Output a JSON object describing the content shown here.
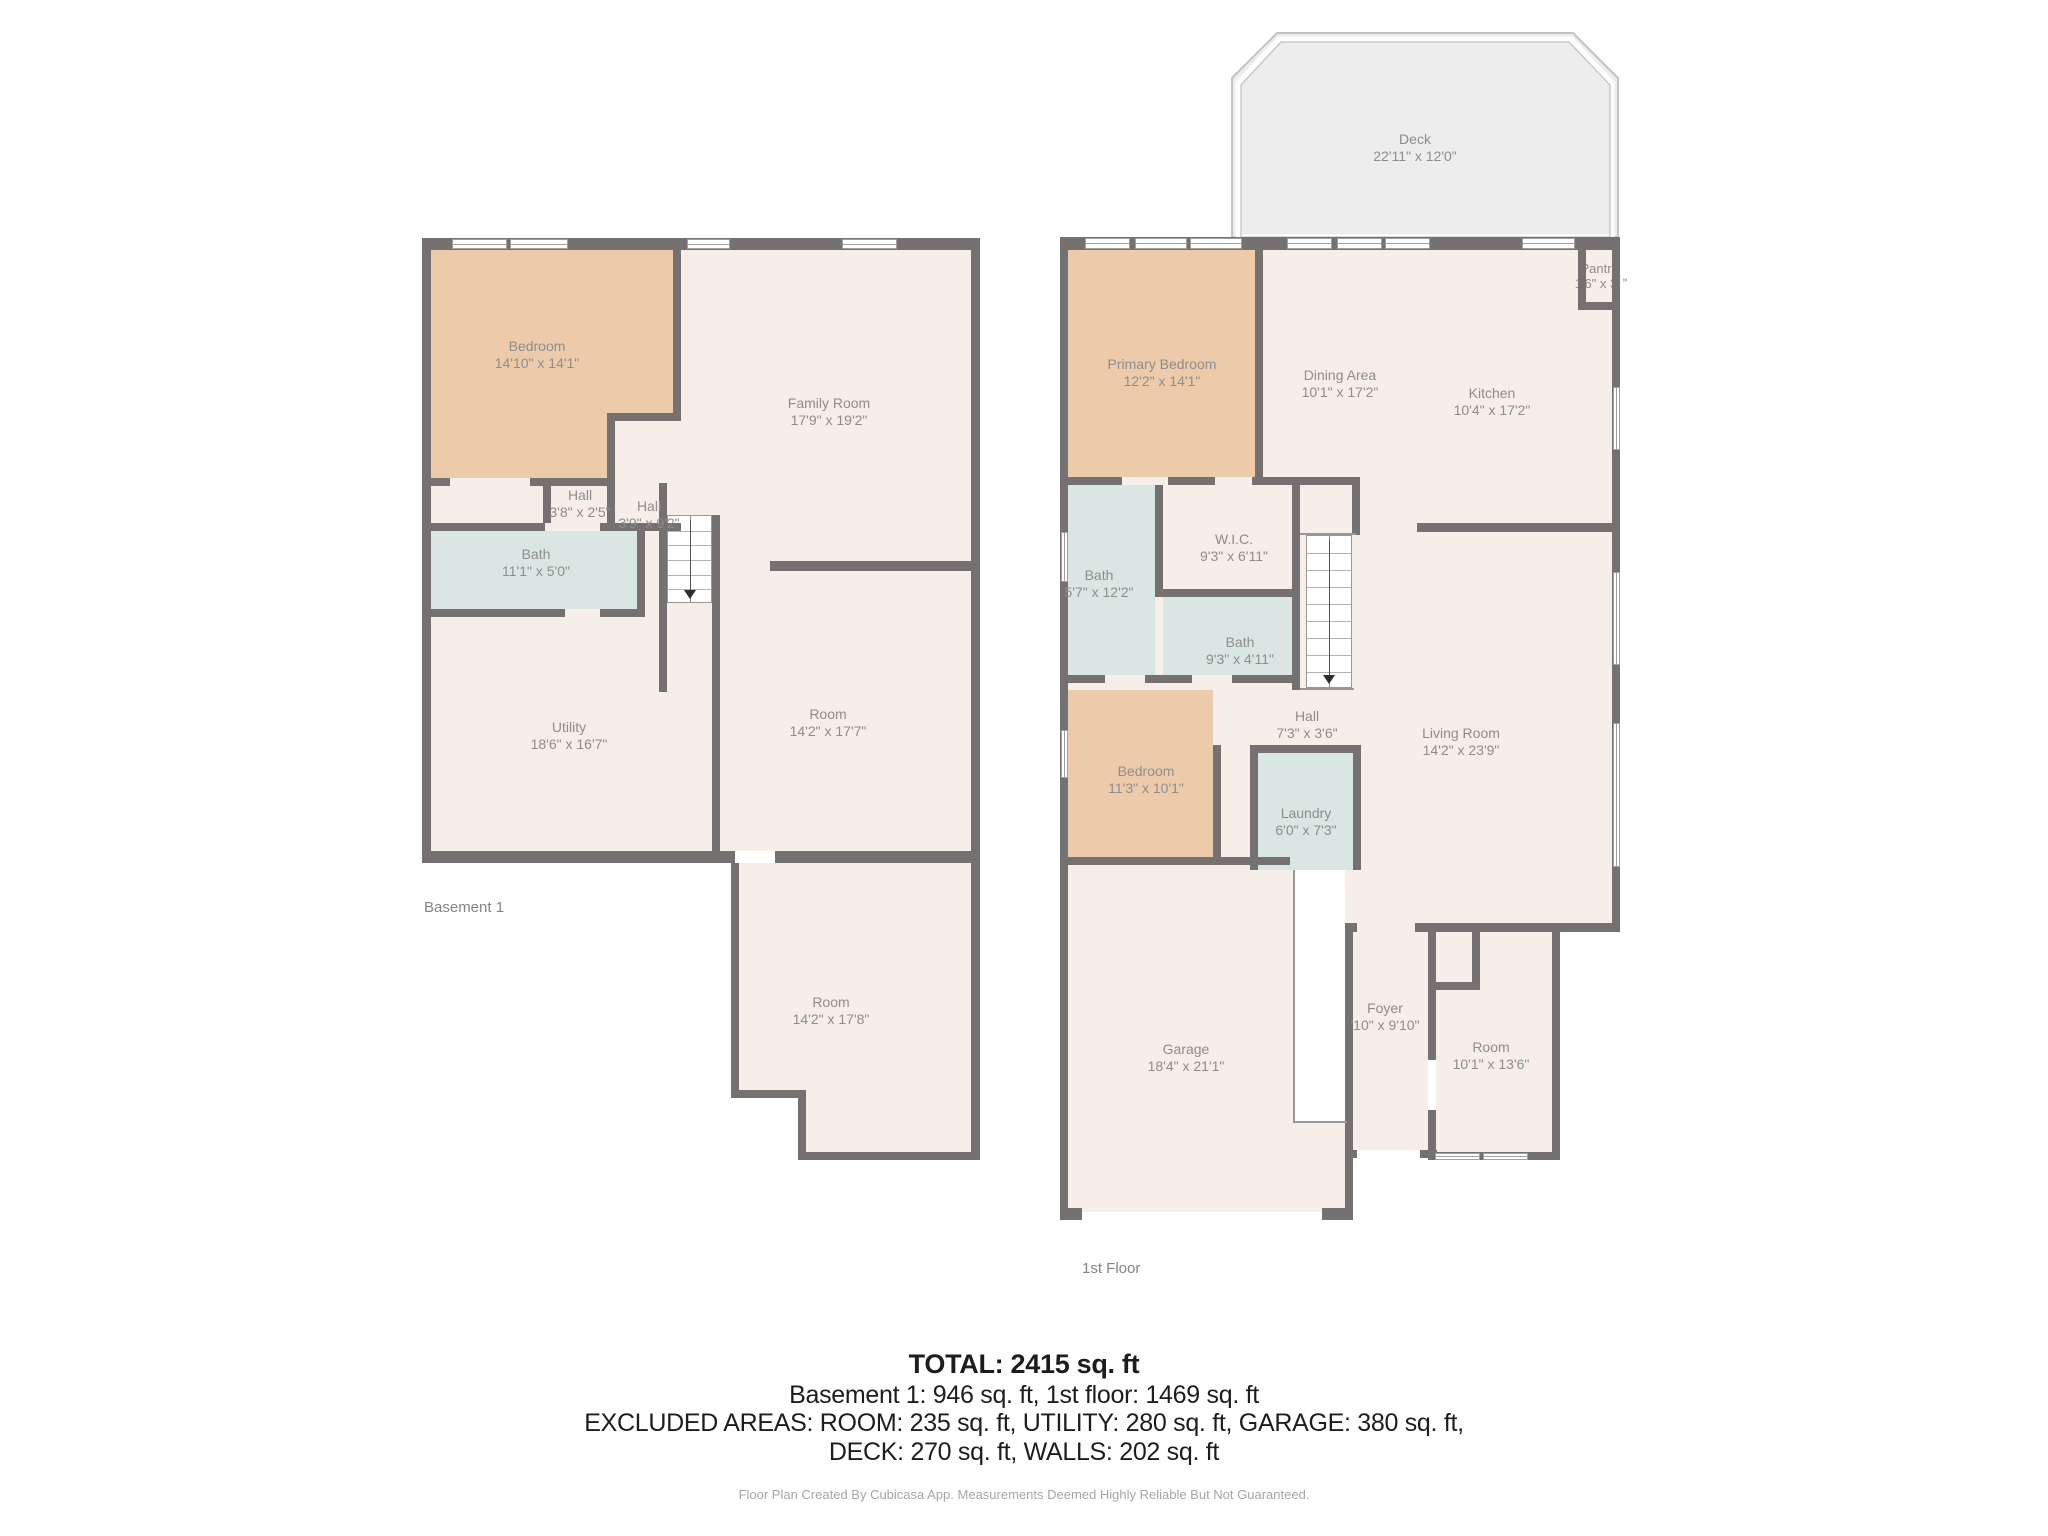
{
  "colors": {
    "wall": "#757170",
    "floor": "#f6eee8",
    "bedroom_fill": "#edcbaa",
    "bath_fill": "#d9e6e3",
    "deck_fill": "#ededed",
    "deck_line": "#c5c2bf",
    "label_text": "#8d8d8d",
    "summary_text": "#1d1d1d",
    "footer_text": "#a6a6a6"
  },
  "basement": {
    "caption": "Basement 1",
    "rooms": [
      {
        "name": "Bedroom",
        "dims": "14'10\" x 14'1\""
      },
      {
        "name": "Family Room",
        "dims": "17'9\" x 19'2\""
      },
      {
        "name": "Hall",
        "dims": "3'8\" x 2'5\""
      },
      {
        "name": "Hall",
        "dims": "3'9\" x 9'2\""
      },
      {
        "name": "Bath",
        "dims": "11'1\" x 5'0\""
      },
      {
        "name": "Utility",
        "dims": "18'6\" x 16'7\""
      },
      {
        "name": "Room",
        "dims": "14'2\" x 17'7\""
      },
      {
        "name": "Room",
        "dims": "14'2\" x 17'8\""
      }
    ]
  },
  "first_floor": {
    "caption": "1st Floor",
    "rooms": [
      {
        "name": "Deck",
        "dims": "22'11\" x 12'0\""
      },
      {
        "name": "Primary Bedroom",
        "dims": "12'2\" x 14'1\""
      },
      {
        "name": "Dining Area",
        "dims": "10'1\" x 17'2\""
      },
      {
        "name": "Kitchen",
        "dims": "10'4\" x 17'2\""
      },
      {
        "name": "Pantr",
        "dims": "1'6\" x 3",
        "overflow_mark": "\""
      },
      {
        "name": "Bath",
        "dims": "5'7\" x 12'2\""
      },
      {
        "name": "W.I.C.",
        "dims": "9'3\" x 6'11\""
      },
      {
        "name": "Bath",
        "dims": "9'3\" x 4'11\""
      },
      {
        "name": "Hall",
        "dims": "7'3\" x 3'6\""
      },
      {
        "name": "Living Room",
        "dims": "14'2\" x 23'9\""
      },
      {
        "name": "Bedroom",
        "dims": "11'3\" x 10'1\""
      },
      {
        "name": "Laundry",
        "dims": "6'0\" x 7'3\""
      },
      {
        "name": "Garage",
        "dims": "18'4\" x 21'1\""
      },
      {
        "name": "Foyer",
        "dims": "'10\" x 9'10\""
      },
      {
        "name": "Room",
        "dims": "10'1\" x 13'6\""
      }
    ]
  },
  "summary": {
    "total": "TOTAL: 2415 sq. ft",
    "line2": "Basement 1: 946 sq. ft, 1st floor: 1469 sq. ft",
    "line3": "EXCLUDED AREAS: ROOM: 235 sq. ft, UTILITY: 280 sq. ft, GARAGE: 380 sq. ft,",
    "line4": "DECK: 270 sq. ft, WALLS: 202 sq. ft",
    "footer": "Floor Plan Created By Cubicasa App. Measurements Deemed Highly Reliable But Not Guaranteed."
  }
}
